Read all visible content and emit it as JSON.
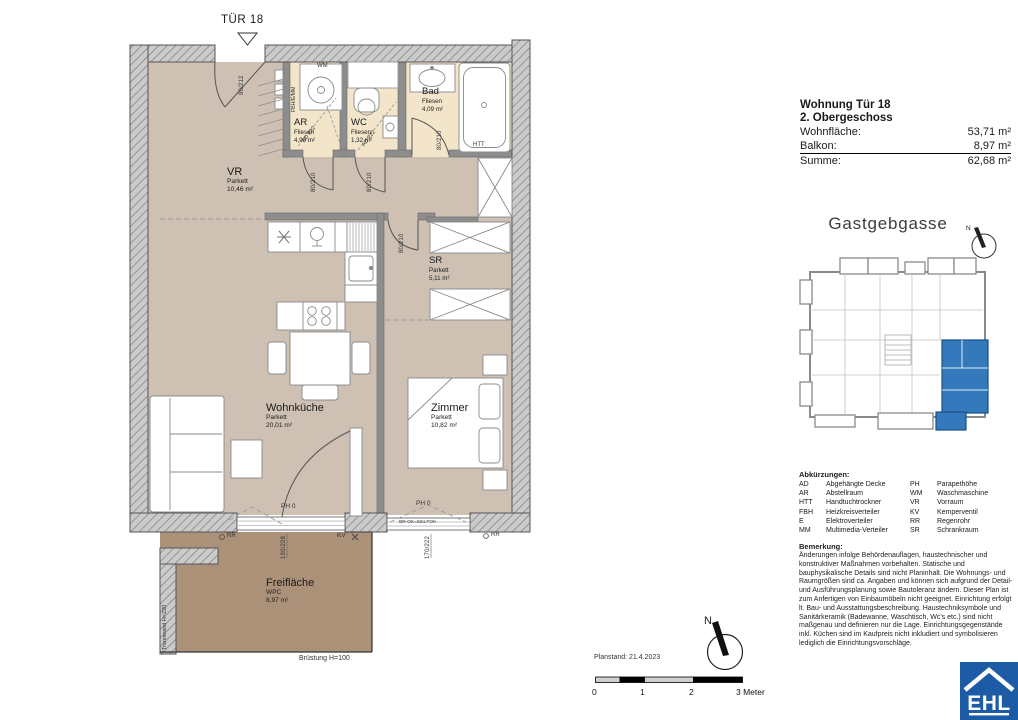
{
  "plan": {
    "tuer_label": "TÜR 18",
    "rooms": [
      {
        "name": "VR",
        "material": "Parkett",
        "area": "10,46 m²"
      },
      {
        "name": "AR",
        "material": "Fliesen",
        "area": "4,90 m²"
      },
      {
        "name": "WC",
        "material": "Fliesen",
        "area": "1,32 m²"
      },
      {
        "name": "Bad",
        "material": "Fliesen",
        "area": "4,09 m²"
      },
      {
        "name": "SR",
        "material": "Parkett",
        "area": "5,11 m²"
      },
      {
        "name": "Wohnküche",
        "material": "Parkett",
        "area": "20,01 m²"
      },
      {
        "name": "Zimmer",
        "material": "Parkett",
        "area": "10,82 m²"
      },
      {
        "name": "Freifläche",
        "material": "WPC",
        "area": "8,97 m²"
      }
    ],
    "ann": {
      "wm": "WM",
      "htt": "HTT",
      "fbh": "FBH/E/MM",
      "ad_ar": "AD 222",
      "ad_wc": "AD 222",
      "dim_entry": "90/212",
      "dim_ar": "80/210",
      "dim_wc": "80/210",
      "dim_bad": "80/210",
      "dim_sr": "80/210",
      "dim_win_left": "190/228",
      "dim_win_right": "170/222",
      "ph_left": "PH 0",
      "ph_right": "PH 0",
      "br_ok": "BR-OK=82ü.FOK",
      "kv": "KV",
      "rr": "RR",
      "trennwand": "Trennwand H=220",
      "bruestung": "Brüstung H=100"
    }
  },
  "info_panel": {
    "title_line1": "Wohnung Tür 18",
    "title_line2": "2. Obergeschoss",
    "rows": [
      {
        "label": "Wohnfläche:",
        "value": "53,71 m²"
      },
      {
        "label": "Balkon:",
        "value": "8,97 m²"
      },
      {
        "label": "Summe:",
        "value": "62,68 m²"
      }
    ]
  },
  "street_label": "Gastgebgasse",
  "compass_letter": "N",
  "abbreviations": {
    "title": "Abkürzungen:",
    "left": [
      {
        "abbr": "AD",
        "term": "Abgehängte Decke"
      },
      {
        "abbr": "AR",
        "term": "Abstellraum"
      },
      {
        "abbr": "HTT",
        "term": "Handtuchtrockner"
      },
      {
        "abbr": "FBH",
        "term": "Heizkreisverteiler"
      },
      {
        "abbr": "E",
        "term": "Elektroverteiler"
      },
      {
        "abbr": "MM",
        "term": "Multimedia-Verteiler"
      }
    ],
    "right": [
      {
        "abbr": "PH",
        "term": "Parapethöhe"
      },
      {
        "abbr": "WM",
        "term": "Waschmaschine"
      },
      {
        "abbr": "VR",
        "term": "Vorraum"
      },
      {
        "abbr": "KV",
        "term": "Kemperventil"
      },
      {
        "abbr": "RR",
        "term": "Regenrohr"
      },
      {
        "abbr": "SR",
        "term": "Schrankraum"
      }
    ]
  },
  "remark": {
    "title": "Bemerkung:",
    "text": "Änderungen infolge Behördenauflagen, haustechnischer und konstruktiver Maßnahmen vorbehalten. Statische und bauphysikalische Details sind nicht Planinhalt. Die Wohnungs- und Raumgrößen sind ca. Angaben und können sich aufgrund der Detail- und Ausführungsplanung sowie Bautoleranz ändern. Dieser Plan ist zum Anfertigen von Einbaumöbeln nicht geeignet. Einrichtung erfolgt lt. Bau- und Ausstattungsbeschreibung. Haustechniksymbole und Sanitärkeramik (Badewanne, Waschtisch, Wc's etc.) sind nicht maßgenau und definieren nur die Lage. Einrichtungsgegenstände inkl. Küchen sind im Kaufpreis nicht inkludiert und symbolisieren lediglich die Einrichtungsvorschläge."
  },
  "footer": {
    "planstand": "Planstand: 21.4.2023",
    "scale_labels": [
      "0",
      "1",
      "2",
      "3 Meter"
    ]
  },
  "logo_text": "EHL",
  "colors": {
    "parkett": "#cec0b3",
    "fliesen": "#f2e5c9",
    "terrasse": "#ac9179",
    "wall": "#8d8d8d",
    "key_blue": "#3579bd",
    "logo_blue": "#1d5ba6"
  }
}
